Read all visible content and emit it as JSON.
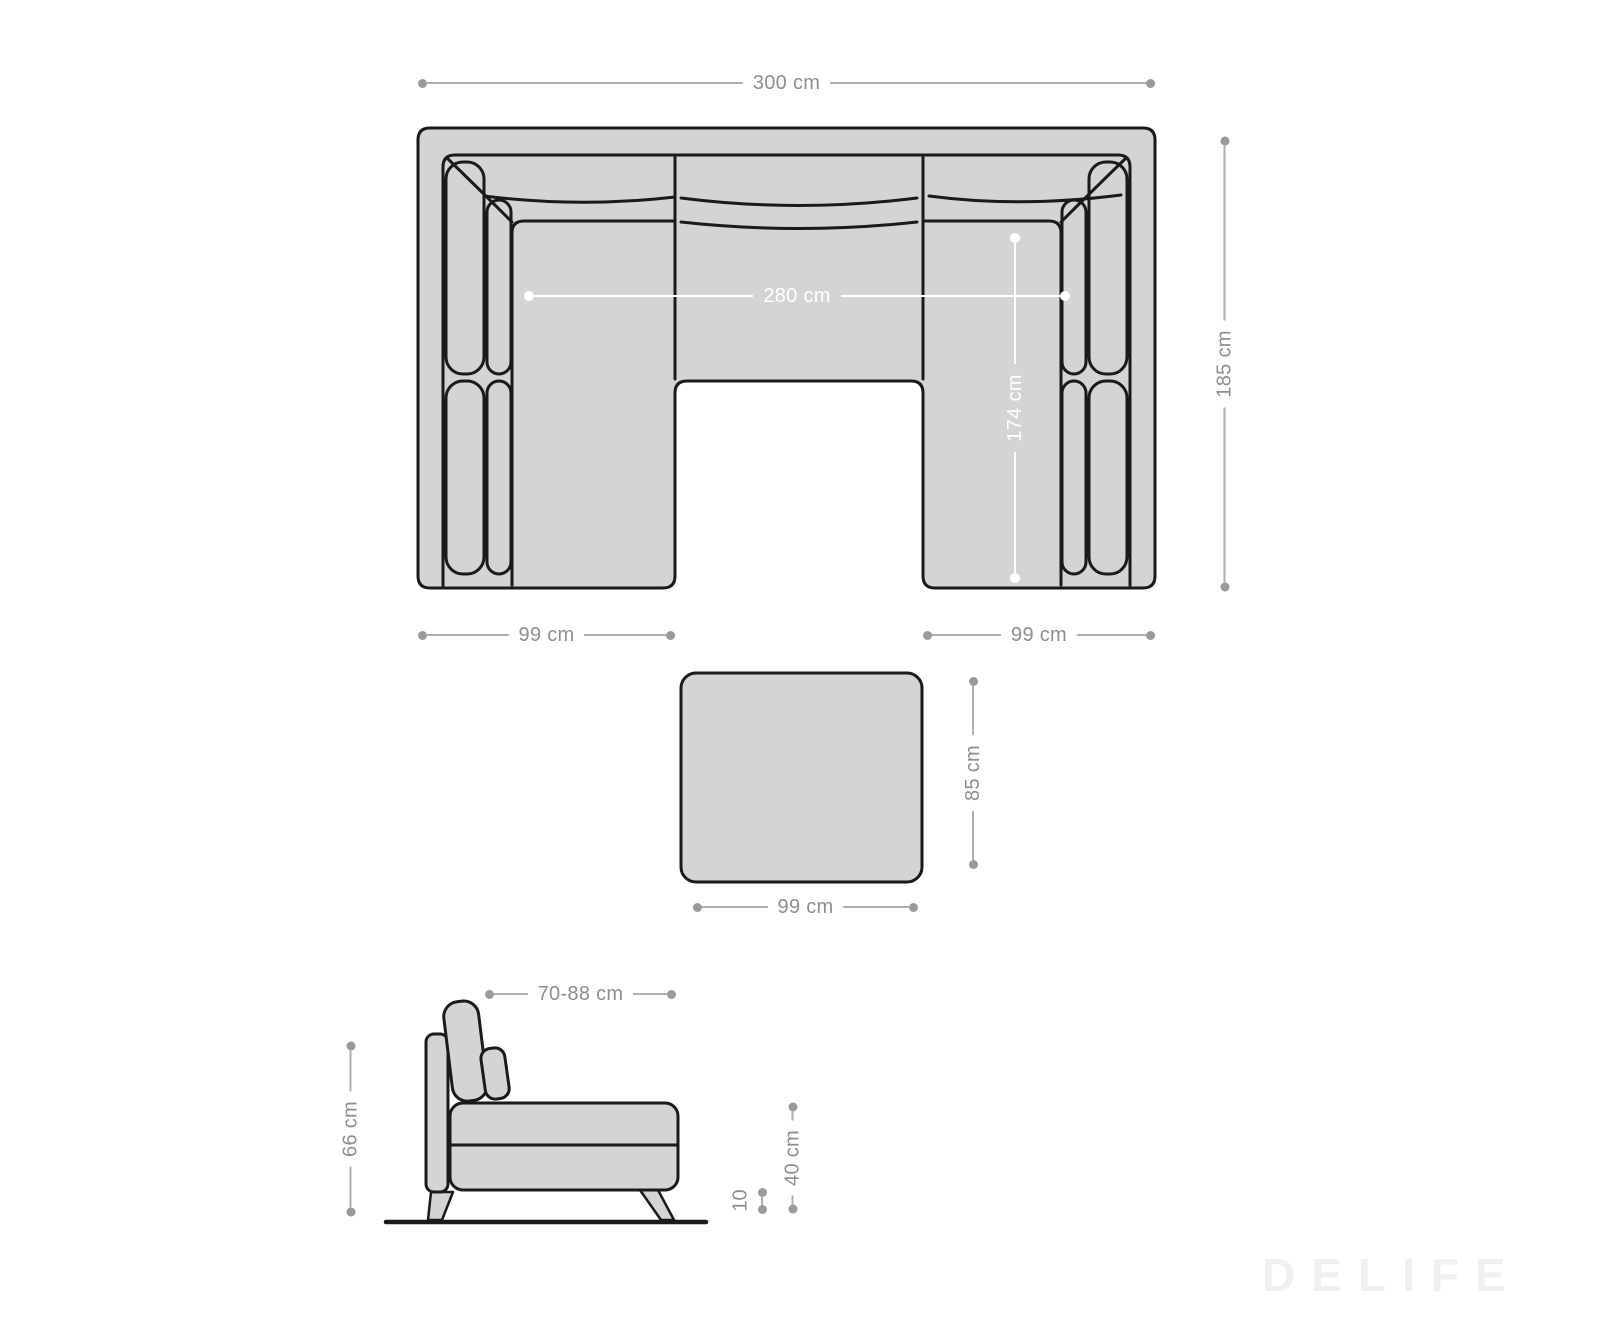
{
  "watermark": {
    "text": "DELIFE"
  },
  "colors": {
    "furniture_fill": "#d4d4d4",
    "outline": "#1a1a1a",
    "dim_line_gray": "#aeaeae",
    "dim_text_gray": "#8e8e8e",
    "dim_white": "#ffffff"
  },
  "sofa_top_view": {
    "overall_width": "300 cm",
    "overall_depth": "185 cm",
    "inner_width": "280 cm",
    "inner_depth": "174 cm",
    "left_recamiere_width": "99 cm",
    "right_recamiere_width": "99 cm"
  },
  "stool_top_view": {
    "depth": "85 cm",
    "width": "99 cm"
  },
  "sofa_side_view": {
    "depth_range": "70-88 cm",
    "back_height": "66 cm",
    "seat_height": "40 cm",
    "leg_height": "10"
  }
}
